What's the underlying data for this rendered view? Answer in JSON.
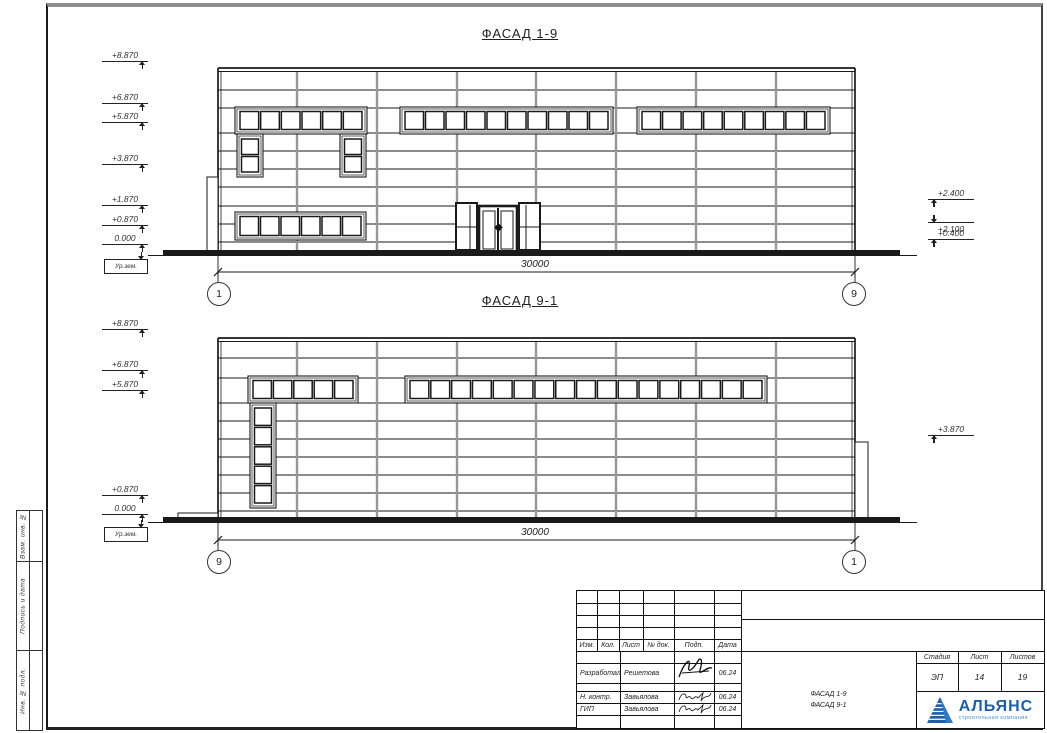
{
  "sheet": {
    "facade1": {
      "title": "ФАСАД 1-9",
      "left_marks": [
        "+8.870",
        "+6.870",
        "+5.870",
        "+3.870",
        "+1.870",
        "+0.870",
        "0.000"
      ],
      "ground_mark": "Ур.зем.",
      "right_marks": [
        "+2.400",
        "+2.100",
        "+0.400"
      ],
      "dimension": "30000",
      "axis_left": "1",
      "axis_right": "9"
    },
    "facade2": {
      "title": "ФАСАД 9-1",
      "left_marks": [
        "+8.870",
        "+6.870",
        "+5.870",
        "+0.870",
        "0.000"
      ],
      "ground_mark": "Ур.зем.",
      "right_marks": [
        "+3.870"
      ],
      "dimension": "30000",
      "axis_left": "9",
      "axis_right": "1"
    },
    "side_strip": {
      "labels": [
        "Взам. инв. №",
        "Подпись и дата",
        "Инв. № подл."
      ]
    },
    "title_block": {
      "header_cols": [
        "Изм.",
        "Кол.",
        "Лист",
        "№ док.",
        "Подп.",
        "Дата"
      ],
      "rows": [
        {
          "role": "Разработал",
          "name": "Решетова",
          "date": "06.24"
        },
        {
          "role": "Н. контр.",
          "name": "Завьялова",
          "date": "06.24"
        },
        {
          "role": "ГИП",
          "name": "Завьялова",
          "date": "06.24"
        }
      ],
      "stage_label": "Стадия",
      "sheet_label": "Лист",
      "sheets_label": "Листов",
      "stage": "ЭП",
      "sheet_no": "14",
      "sheets_total": "19",
      "doc_title_line1": "ФАСАД 1-9",
      "doc_title_line2": "ФАСАД 9-1",
      "company_name": "АЛЬЯНС",
      "company_sub": "строительная компания",
      "brand_color": "#1d5fae",
      "brand_sub_color": "#4b8fd5"
    }
  }
}
